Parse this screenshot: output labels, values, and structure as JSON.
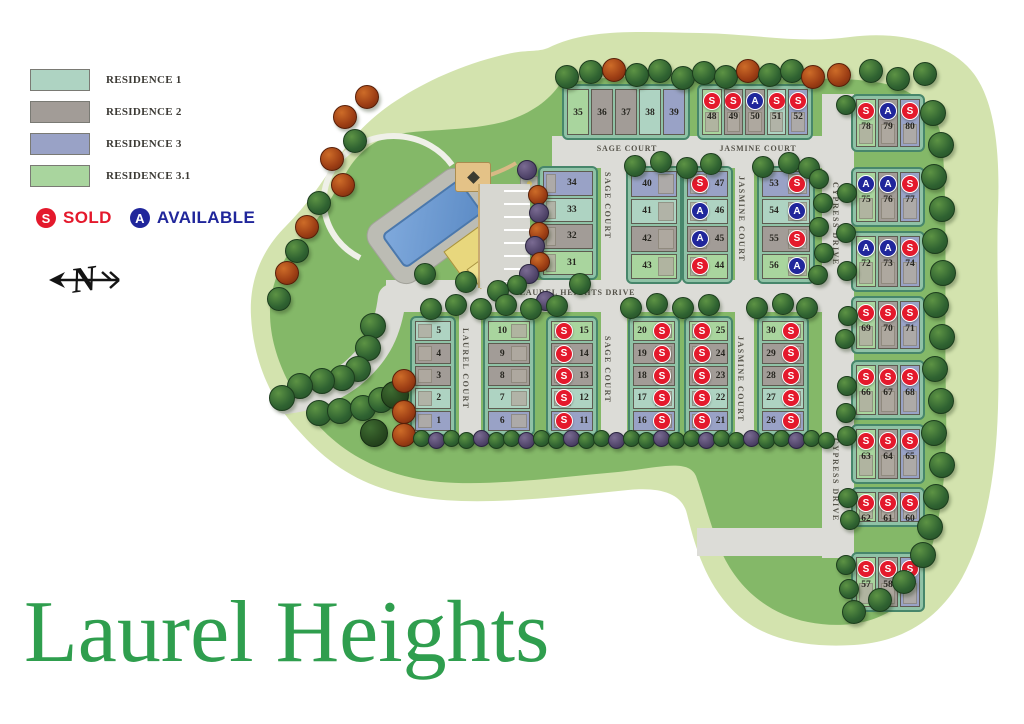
{
  "title": "Laurel Heights",
  "legend": {
    "items": [
      {
        "label": "RESIDENCE 1",
        "color": "#aed3c2"
      },
      {
        "label": "RESIDENCE 2",
        "color": "#a29c97"
      },
      {
        "label": "RESIDENCE 3",
        "color": "#99a2c6"
      },
      {
        "label": "RESIDENCE 3.1",
        "color": "#a9d59e"
      }
    ],
    "sold": {
      "symbol": "S",
      "label": "SOLD",
      "color": "#e4192c"
    },
    "available": {
      "symbol": "A",
      "label": "AVAILABLE",
      "color": "#20269b"
    }
  },
  "residence_colors": {
    "r1": "#aed3c2",
    "r2": "#a29c97",
    "r3": "#99a2c6",
    "r31": "#a9d59e"
  },
  "status_colors": {
    "S": "#e4192c",
    "A": "#20269b"
  },
  "streets": {
    "laurel_heights_drive": "LAUREL HEIGHTS DRIVE",
    "sage_court": "SAGE COURT",
    "jasmine_court": "JASMINE COURT",
    "cypress_drive": "CYPRESS DRIVE",
    "laurel_court": "LAUREL COURT"
  },
  "blocks": {
    "b35": [
      {
        "n": "35",
        "res": "r31"
      },
      {
        "n": "36",
        "res": "r2"
      },
      {
        "n": "37",
        "res": "r2"
      },
      {
        "n": "38",
        "res": "r1"
      },
      {
        "n": "39",
        "res": "r3"
      }
    ],
    "b48": [
      {
        "n": "48",
        "res": "r31",
        "st": "S"
      },
      {
        "n": "49",
        "res": "r2",
        "st": "S"
      },
      {
        "n": "50",
        "res": "r2",
        "st": "A"
      },
      {
        "n": "51",
        "res": "r1",
        "st": "S"
      },
      {
        "n": "52",
        "res": "r3",
        "st": "S"
      }
    ],
    "b78": [
      {
        "n": "78",
        "res": "r31",
        "st": "S"
      },
      {
        "n": "79",
        "res": "r2",
        "st": "A"
      },
      {
        "n": "80",
        "res": "r3",
        "st": "S"
      }
    ],
    "b75": [
      {
        "n": "75",
        "res": "r31",
        "st": "A"
      },
      {
        "n": "76",
        "res": "r2",
        "st": "A"
      },
      {
        "n": "77",
        "res": "r3",
        "st": "S"
      }
    ],
    "b72": [
      {
        "n": "72",
        "res": "r31",
        "st": "A"
      },
      {
        "n": "73",
        "res": "r2",
        "st": "A"
      },
      {
        "n": "74",
        "res": "r3",
        "st": "S"
      }
    ],
    "b69": [
      {
        "n": "69",
        "res": "r31",
        "st": "S"
      },
      {
        "n": "70",
        "res": "r2",
        "st": "S"
      },
      {
        "n": "71",
        "res": "r3",
        "st": "S"
      }
    ],
    "b66": [
      {
        "n": "66",
        "res": "r31",
        "st": "S"
      },
      {
        "n": "67",
        "res": "r2",
        "st": "S"
      },
      {
        "n": "68",
        "res": "r3",
        "st": "S"
      }
    ],
    "b63": [
      {
        "n": "63",
        "res": "r31",
        "st": "S"
      },
      {
        "n": "64",
        "res": "r2",
        "st": "S"
      },
      {
        "n": "65",
        "res": "r3",
        "st": "S"
      }
    ],
    "b60": [
      {
        "n": "62",
        "res": "r31",
        "st": "S"
      },
      {
        "n": "61",
        "res": "r2",
        "st": "S"
      },
      {
        "n": "60",
        "res": "r3",
        "st": "S"
      }
    ],
    "b57": [
      {
        "n": "57",
        "res": "r31",
        "st": "S"
      },
      {
        "n": "58",
        "res": "r2",
        "st": "S"
      },
      {
        "n": "59",
        "res": "r3",
        "st": "S"
      }
    ],
    "b31": [
      {
        "n": "34",
        "res": "r3"
      },
      {
        "n": "33",
        "res": "r1"
      },
      {
        "n": "32",
        "res": "r2"
      },
      {
        "n": "31",
        "res": "r31"
      }
    ],
    "b40": [
      {
        "n": "40",
        "res": "r3"
      },
      {
        "n": "41",
        "res": "r1"
      },
      {
        "n": "42",
        "res": "r2"
      },
      {
        "n": "43",
        "res": "r31"
      }
    ],
    "b44": [
      {
        "n": "47",
        "res": "r3",
        "st": "S"
      },
      {
        "n": "46",
        "res": "r1",
        "st": "A"
      },
      {
        "n": "45",
        "res": "r2",
        "st": "A"
      },
      {
        "n": "44",
        "res": "r31",
        "st": "S"
      }
    ],
    "b53": [
      {
        "n": "53",
        "res": "r3",
        "st": "S"
      },
      {
        "n": "54",
        "res": "r1",
        "st": "A"
      },
      {
        "n": "55",
        "res": "r2",
        "st": "S"
      },
      {
        "n": "56",
        "res": "r31",
        "st": "A"
      }
    ],
    "b1": [
      {
        "n": "5",
        "res": "r1"
      },
      {
        "n": "4",
        "res": "r2"
      },
      {
        "n": "3",
        "res": "r2"
      },
      {
        "n": "2",
        "res": "r1"
      },
      {
        "n": "1",
        "res": "r3"
      }
    ],
    "b6": [
      {
        "n": "10",
        "res": "r31"
      },
      {
        "n": "9",
        "res": "r2"
      },
      {
        "n": "8",
        "res": "r2"
      },
      {
        "n": "7",
        "res": "r1"
      },
      {
        "n": "6",
        "res": "r3"
      }
    ],
    "b11": [
      {
        "n": "15",
        "res": "r31",
        "st": "S"
      },
      {
        "n": "14",
        "res": "r2",
        "st": "S"
      },
      {
        "n": "13",
        "res": "r2",
        "st": "S"
      },
      {
        "n": "12",
        "res": "r1",
        "st": "S"
      },
      {
        "n": "11",
        "res": "r3",
        "st": "S"
      }
    ],
    "b16": [
      {
        "n": "20",
        "res": "r31",
        "st": "S"
      },
      {
        "n": "19",
        "res": "r2",
        "st": "S"
      },
      {
        "n": "18",
        "res": "r2",
        "st": "S"
      },
      {
        "n": "17",
        "res": "r1",
        "st": "S"
      },
      {
        "n": "16",
        "res": "r3",
        "st": "S"
      }
    ],
    "b21": [
      {
        "n": "25",
        "res": "r31",
        "st": "S"
      },
      {
        "n": "24",
        "res": "r2",
        "st": "S"
      },
      {
        "n": "23",
        "res": "r2",
        "st": "S"
      },
      {
        "n": "22",
        "res": "r1",
        "st": "S"
      },
      {
        "n": "21",
        "res": "r3",
        "st": "S"
      }
    ],
    "b26": [
      {
        "n": "30",
        "res": "r31",
        "st": "S"
      },
      {
        "n": "29",
        "res": "r2",
        "st": "S"
      },
      {
        "n": "28",
        "res": "r2",
        "st": "S"
      },
      {
        "n": "27",
        "res": "r1",
        "st": "S"
      },
      {
        "n": "26",
        "res": "r3",
        "st": "S"
      }
    ]
  }
}
